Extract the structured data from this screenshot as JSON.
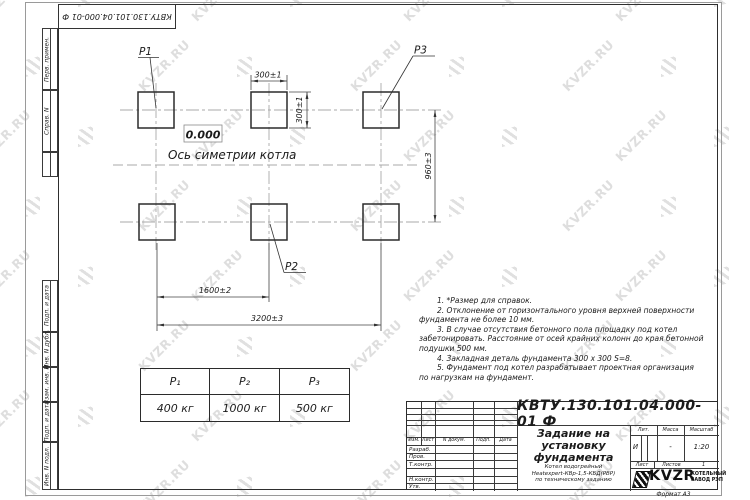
{
  "page": {
    "sheet_doc_number": "КВТУ.130.101.04.000-01  Ф",
    "format_note": "Формат А3"
  },
  "watermark": {
    "text": "KVZR.RU",
    "icon": "kvzr-stripes-icon",
    "color": "#c9c9c9"
  },
  "margin": {
    "perv": "Перв. примен.",
    "sprav": "Справ. N",
    "podp_data_1": "Подп. и дата",
    "inv_dubl": "Инв. N дубл.",
    "vzam_inv": "Взам. инв. N",
    "podp_data_2": "Подп. и дата",
    "inv_podl": "Инв. N подл."
  },
  "drawing": {
    "labels": {
      "p1": "P1",
      "p2": "P2",
      "p3": "P3"
    },
    "level_mark": "0.000",
    "axis_caption": "Ось симетрии котла",
    "dims": {
      "col_width": "300±1",
      "col_height": "300±1",
      "row_spacing": "960±3",
      "span_half": "1600±2",
      "span_full": "3200±3"
    }
  },
  "notes": {
    "lines": [
      "1.  *Размер для справок.",
      "2.  Отклонение от горизонтального уровня верхней поверхности",
      "фундамента не более 10 мм.",
      "3.  В случае отсутствия бетонного пола площадку под котел",
      "забетонировать. Расстояние от осей крайних колонн до края бетонной",
      "подушки 500 мм.",
      "4.  Закладная деталь фундамента  300 x 300 S=8.",
      "5.  Фундамент под котел разрабатывает проектная организация",
      "по нагрузкам на фундамент."
    ]
  },
  "load_table": {
    "headers": [
      "Р₁",
      "Р₂",
      "Р₃"
    ],
    "values": [
      "400 кг",
      "1000 кг",
      "500 кг"
    ]
  },
  "title_block": {
    "doc_number": "КВТУ.130.101.04.000-01  Ф",
    "title_line1": "Задание на",
    "title_line2": "установку",
    "title_line3": "фундамента",
    "product_line1": "Котел водогрейный",
    "product_line2": "Heatexpert-КВр-1,5-КБД(РВР)",
    "product_line3": "по техническому заданию",
    "cols": {
      "izm": "Изм.",
      "list": "Лист",
      "ndok": "N докум.",
      "podp": "Подп.",
      "data": "Дата"
    },
    "rows": {
      "razrab": "Разраб.",
      "prov": "Пров.",
      "tkontr": "Т.контр.",
      "nkontr": "Н.контр.",
      "utv": "Утв."
    },
    "lit": {
      "label": "Лит.",
      "value": "И"
    },
    "massa": {
      "label": "Масса",
      "value": "-"
    },
    "masshtab": {
      "label": "Масштаб",
      "value": "1:20"
    },
    "list_row": {
      "list_label": "Лист",
      "listov_label": "Листов",
      "listov_value": "1"
    },
    "brand": {
      "name": "KVZR",
      "sub1": "КОТЕЛЬНЫЙ",
      "sub2": "ЗАВОД РЭП"
    }
  },
  "colors": {
    "line": "#2b2b2b",
    "centerline": "#a9a9a9",
    "watermark": "#c9c9c9"
  }
}
